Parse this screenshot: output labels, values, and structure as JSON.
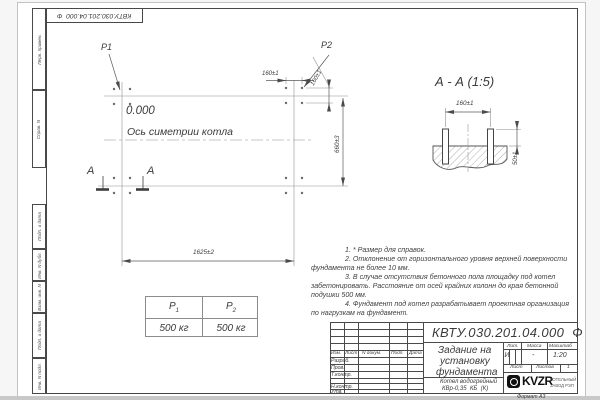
{
  "sheet": {
    "stamp_top": "КВТУ.030.201.04.000  Ф",
    "format_note": "Формат А3",
    "frame_labels": [
      "Перв. примен.",
      "Справ. N",
      "Подп. и дата",
      "Инв. N дубл.",
      "Взам. инв. N",
      "Подп. и дата",
      "Инв. N подл."
    ]
  },
  "plan": {
    "p1": "P1",
    "p2": "P2",
    "elevation": "0.000",
    "axis_label": "Ось симетрии котла",
    "dim_length": "1625±2",
    "dim_width": "660±3",
    "dim_bolt_spacing_h": "160±1",
    "dim_bolt_spacing_v": "160±1",
    "section_mark_left": "А",
    "section_mark_right": "А"
  },
  "section": {
    "title": "А - А (1:5)",
    "dim_bolt_spacing": "160±1",
    "dim_bolt_height": "50±1"
  },
  "notes": {
    "lines": [
      "1. * Размер для справок.",
      "2. Отклонение от горизонтального уровня верхней поверхности",
      "фундамента не более 10 мм.",
      "3. В случае отсутствия бетонного пола площадку под котел",
      "забетонировать. Расстояние от осей крайних колонн до края бетонной",
      "подушки 500 мм.",
      "4. Фундамент под котел разрабатывает проектная организация",
      "по нагрузкам на фундамент."
    ]
  },
  "load_table": {
    "col1": {
      "label_base": "P",
      "label_sub": "1",
      "value": "500 кг"
    },
    "col2": {
      "label_base": "P",
      "label_sub": "2",
      "value": "500 кг"
    }
  },
  "title_block": {
    "doc_number": "КВТУ.030.201.04.000  Ф",
    "title_lines": [
      "Задание на",
      "установку",
      "фундамента"
    ],
    "product_lines": [
      "Котел водогрейный",
      "КВр-0,35  КБ  (К)"
    ],
    "cols": {
      "izm": "Изм.",
      "list": "Лист",
      "doc": "N докум.",
      "podp": "Подп.",
      "data": "Дата"
    },
    "rows": {
      "razrab": "Разраб.",
      "prov": "Пров.",
      "tkontr": "Т.контр.",
      "nkontr": "Н.контр.",
      "utv": "Утв."
    },
    "lit_label": "Лит.",
    "mass_label": "Масса",
    "scale_label": "Масштаб",
    "lit_value": "И",
    "mass_value": "-",
    "scale_value": "1:20",
    "sheet_label": "Лист",
    "sheets_label": "Листов",
    "sheets_value": "1",
    "logo": {
      "text": "KVZR",
      "sub1": "КОТЕЛЬНЫЙ",
      "sub2": "ЗАВОД РЭП"
    }
  }
}
